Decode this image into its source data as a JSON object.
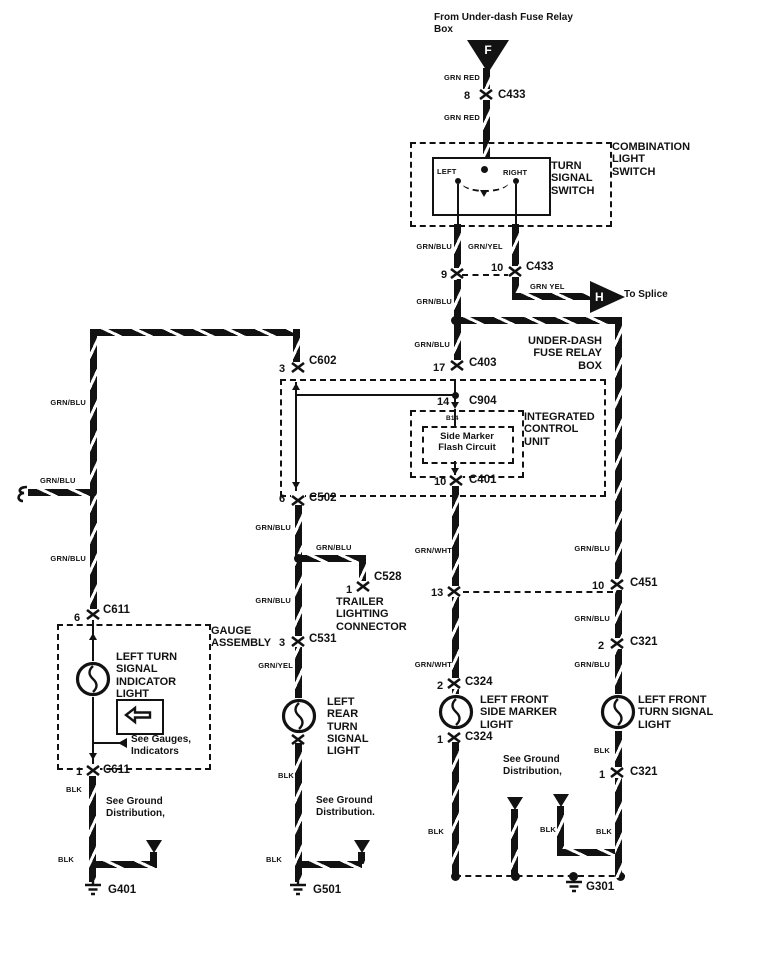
{
  "top": {
    "source": "From Under-dash Fuse Relay\nBox",
    "f_marker": "F",
    "wire_grn_red_upper": "GRN RED",
    "pin_8": "8",
    "c433_upper": "C433",
    "wire_grn_red_lower": "GRN RED"
  },
  "combo_switch": {
    "label": "COMBINATION\nLIGHT\nSWITCH",
    "inner_label": "TURN\nSIGNAL\nSWITCH",
    "left_pos": "LEFT",
    "right_pos": "RIGHT"
  },
  "switch_out": {
    "wire_grn_blu": "GRN/BLU",
    "wire_grn_yel": "GRN/YEL",
    "pin_9": "9",
    "pin_10": "10",
    "c433_lower": "C433",
    "wire_grn_yel_splice": "GRN YEL",
    "h_marker": "H",
    "to_splice": "To Splice",
    "wire_grn_blu_2": "GRN/BLU"
  },
  "fuse_box": {
    "label": "UNDER-DASH\nFUSE RELAY\nBOX",
    "wire_grn_blu": "GRN/BLU",
    "pin_17": "17",
    "c403": "C403",
    "pin_3": "3",
    "c602": "C602",
    "pin_14": "14",
    "c904": "C904",
    "icu_label": "INTEGRATED\nCONTROL\nUNIT",
    "b14": "B14",
    "flash_circuit": "Side Marker\nFlash Circuit",
    "pin_10": "10",
    "c401": "C401",
    "pin_6": "6",
    "c502": "C502"
  },
  "col1": {
    "wire_grn_blu_a": "GRN/BLU",
    "splice_label": "GRN/BLU",
    "wire_grn_blu_b": "GRN/BLU",
    "pin_6": "6",
    "c611_top": "C611",
    "gauge_label": "GAUGE\nASSEMBLY",
    "light_label": "LEFT TURN\nSIGNAL\nINDICATOR\nLIGHT",
    "see_gauges": "See Gauges,\nIndicators",
    "pin_1": "1",
    "c611_bottom": "C611",
    "blk_a": "BLK",
    "see_ground": "See Ground\nDistribution,",
    "blk_b": "BLK",
    "ground": "G401"
  },
  "col2": {
    "wire_grn_blu_a": "GRN/BLU",
    "branch_label": "GRN/BLU",
    "pin_1": "1",
    "c528": "C528",
    "trailer_label": "TRAILER\nLIGHTING\nCONNECTOR",
    "wire_grn_blu_b": "GRN/BLU",
    "pin_3": "3",
    "c531": "C531",
    "wire_grn_yel": "GRN/YEL",
    "light_label": "LEFT\nREAR\nTURN\nSIGNAL\nLIGHT",
    "blk_a": "BLK",
    "see_ground": "See Ground\nDistribution.",
    "blk_b": "BLK",
    "ground": "G501"
  },
  "col3": {
    "wire_grn_wht_a": "GRN/WHT",
    "pin_13": "13",
    "wire_grn_wht_b": "GRN/WHT",
    "pin_2": "2",
    "c324_top": "C324",
    "light_label": "LEFT FRONT\nSIDE MARKER\nLIGHT",
    "pin_1": "1",
    "c324_bottom": "C324",
    "blk_a": "BLK",
    "see_ground": "See Ground\nDistribution,",
    "ground": "G301"
  },
  "col4": {
    "wire_grn_blu_a": "GRN/BLU",
    "pin_10": "10",
    "c451": "C451",
    "wire_grn_blu_b": "GRN/BLU",
    "pin_2": "2",
    "c321_top": "C321",
    "wire_grn_blu_c": "GRN/BLU",
    "light_label": "LEFT FRONT\nTURN SIGNAL\nLIGHT",
    "blk_a": "BLK",
    "pin_1": "1",
    "c321_bottom": "C321",
    "blk_b": "BLK",
    "blk_c": "BLK"
  }
}
